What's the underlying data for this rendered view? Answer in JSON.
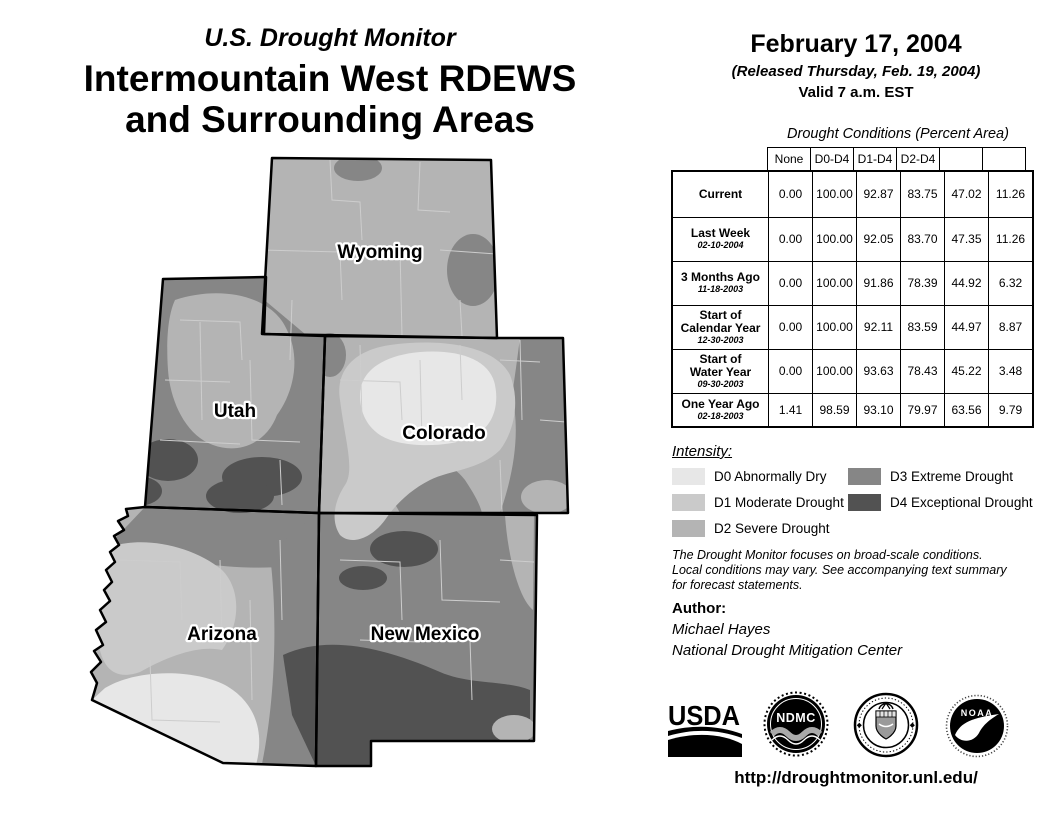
{
  "palette": {
    "white": "#ffffff",
    "d0": "#e7e7e7",
    "d1": "#cacaca",
    "d2": "#b4b4b4",
    "d3": "#868686",
    "d4": "#525252",
    "county_line": "#cdcdcd"
  },
  "titles": {
    "monitor": "U.S. Drought Monitor",
    "region_line1": "Intermountain West RDEWS",
    "region_line2": "and Surrounding Areas"
  },
  "date_block": {
    "date": "February 17, 2004",
    "released": "(Released Thursday, Feb. 19, 2004)",
    "valid": "Valid 7 a.m. EST"
  },
  "map": {
    "states": [
      {
        "label": "Wyoming"
      },
      {
        "label": "Utah"
      },
      {
        "label": "Colorado"
      },
      {
        "label": "Arizona"
      },
      {
        "label": "New Mexico"
      }
    ]
  },
  "table": {
    "title": "Drought Conditions (Percent Area)",
    "columns": [
      "None",
      "D0-D4",
      "D1-D4",
      "D2-D4",
      "D3-D4",
      "D4"
    ],
    "rows": [
      {
        "label": "Current",
        "date": "",
        "values": [
          "0.00",
          "100.00",
          "92.87",
          "83.75",
          "47.02",
          "11.26"
        ]
      },
      {
        "label": "Last Week",
        "date": "02-10-2004",
        "values": [
          "0.00",
          "100.00",
          "92.05",
          "83.70",
          "47.35",
          "11.26"
        ]
      },
      {
        "label": "3 Months Ago",
        "date": "11-18-2003",
        "values": [
          "0.00",
          "100.00",
          "91.86",
          "78.39",
          "44.92",
          "6.32"
        ]
      },
      {
        "label": "Start of\nCalendar Year",
        "date": "12-30-2003",
        "values": [
          "0.00",
          "100.00",
          "92.11",
          "83.59",
          "44.97",
          "8.87"
        ]
      },
      {
        "label": "Start of\nWater Year",
        "date": "09-30-2003",
        "values": [
          "0.00",
          "100.00",
          "93.63",
          "78.43",
          "45.22",
          "3.48"
        ]
      },
      {
        "label": "One Year Ago",
        "date": "02-18-2003",
        "values": [
          "1.41",
          "98.59",
          "93.10",
          "79.97",
          "63.56",
          "9.79"
        ]
      }
    ]
  },
  "legend": {
    "title": "Intensity:",
    "items": [
      {
        "label": "D0 Abnormally Dry"
      },
      {
        "label": "D1 Moderate Drought"
      },
      {
        "label": "D2 Severe Drought"
      },
      {
        "label": "D3 Extreme Drought"
      },
      {
        "label": "D4 Exceptional Drought"
      }
    ]
  },
  "notes": {
    "disclaimer": "The Drought Monitor focuses on broad-scale conditions.\nLocal conditions may vary. See accompanying text summary\nfor forecast statements."
  },
  "author": {
    "heading": "Author:",
    "name": "Michael Hayes",
    "org": "National Drought Mitigation Center"
  },
  "logos": {
    "usda": "USDA",
    "ndmc": "NDMC",
    "noaa": "NOAA"
  },
  "footer": {
    "url": "http://droughtmonitor.unl.edu/"
  }
}
